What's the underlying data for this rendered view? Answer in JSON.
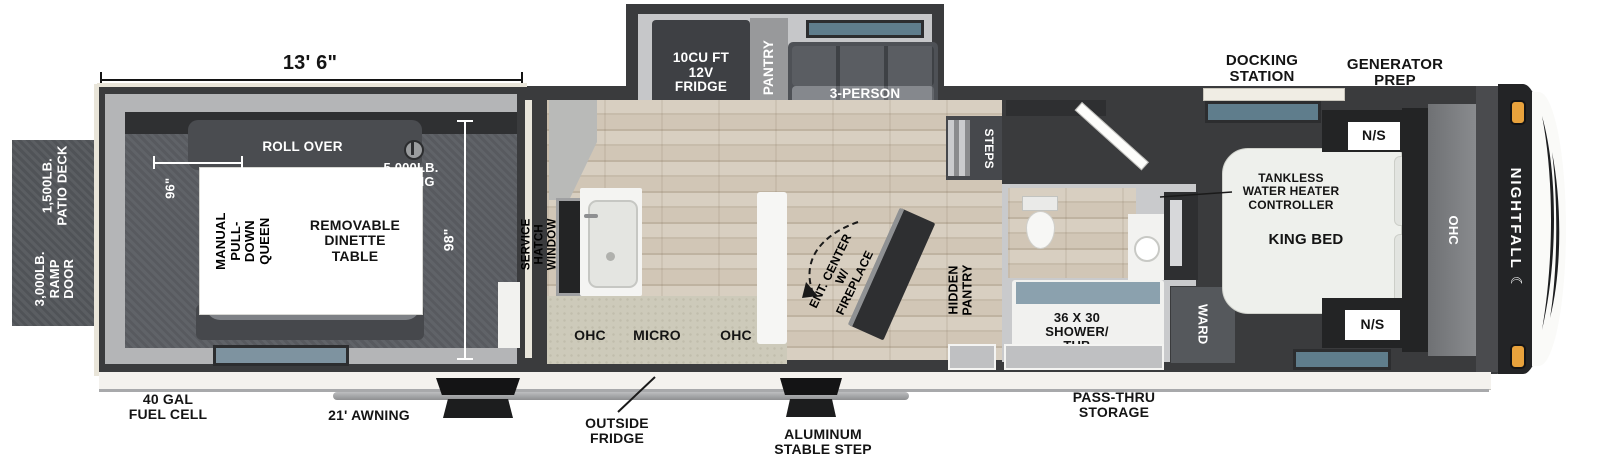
{
  "brand": {
    "name": "NIGHTFALL"
  },
  "icons": {
    "moon": "☾"
  },
  "colors": {
    "wall": "#3a3b3d",
    "cap_black": "#232426",
    "amber_light": "#e8a23c",
    "window_teal": "#5f7d8c",
    "tub_water": "#8ba1ae",
    "counter_beige": "#cdcaba",
    "cream_trim": "#e9e5d9",
    "label_black": "#141414",
    "label_white": "#ffffff"
  },
  "dimensions": {
    "garage_length": "13' 6\"",
    "bed_width": "96\"",
    "garage_width": "98\""
  },
  "left_exterior": {
    "patio_deck": "1,500LB.\nPATIO DECK",
    "ramp_door": "3,000LB.\nRAMP DOOR"
  },
  "garage": {
    "roll_over_top": "ROLL OVER",
    "roll_over_bottom": "ROLL OVER",
    "queen_bed": "MANUAL\nPULL-DOWN\nQUEEN",
    "dinette": "REMOVABLE\nDINETTE\nTABLE",
    "d_ring": "5,000LB.\nD-RING"
  },
  "slideout": {
    "fridge": "10CU FT\n12V\nFRIDGE",
    "pantry": "PANTRY",
    "sofa": "3-PERSON\nSOFA"
  },
  "kitchen": {
    "service_hatch": "SERVICE HATCH\nWINDOW",
    "ohc_left": "OHC",
    "micro": "MICRO",
    "ohc_right": "OHC",
    "ent_center": "ENT. CENTER\nW/ FIREPLACE",
    "hidden_pantry": "HIDDEN\nPANTRY",
    "steps": "STEPS"
  },
  "bathroom": {
    "shower_tub": "36 X 30\nSHOWER/\nTUB",
    "ward": "WARD"
  },
  "bedroom": {
    "tankless": "TANKLESS\nWATER HEATER\nCONTROLLER",
    "king_bed": "KING BED",
    "ns_top": "N/S",
    "ns_bottom": "N/S",
    "ohc": "OHC"
  },
  "top_exterior": {
    "docking_station": "DOCKING\nSTATION",
    "generator_prep": "GENERATOR\nPREP"
  },
  "bottom_exterior": {
    "fuel_cell": "40 GAL\nFUEL CELL",
    "awning": "21' AWNING",
    "outside_fridge": "OUTSIDE\nFRIDGE",
    "stable_step": "ALUMINUM\nSTABLE STEP",
    "pass_thru": "PASS-THRU\nSTORAGE"
  }
}
